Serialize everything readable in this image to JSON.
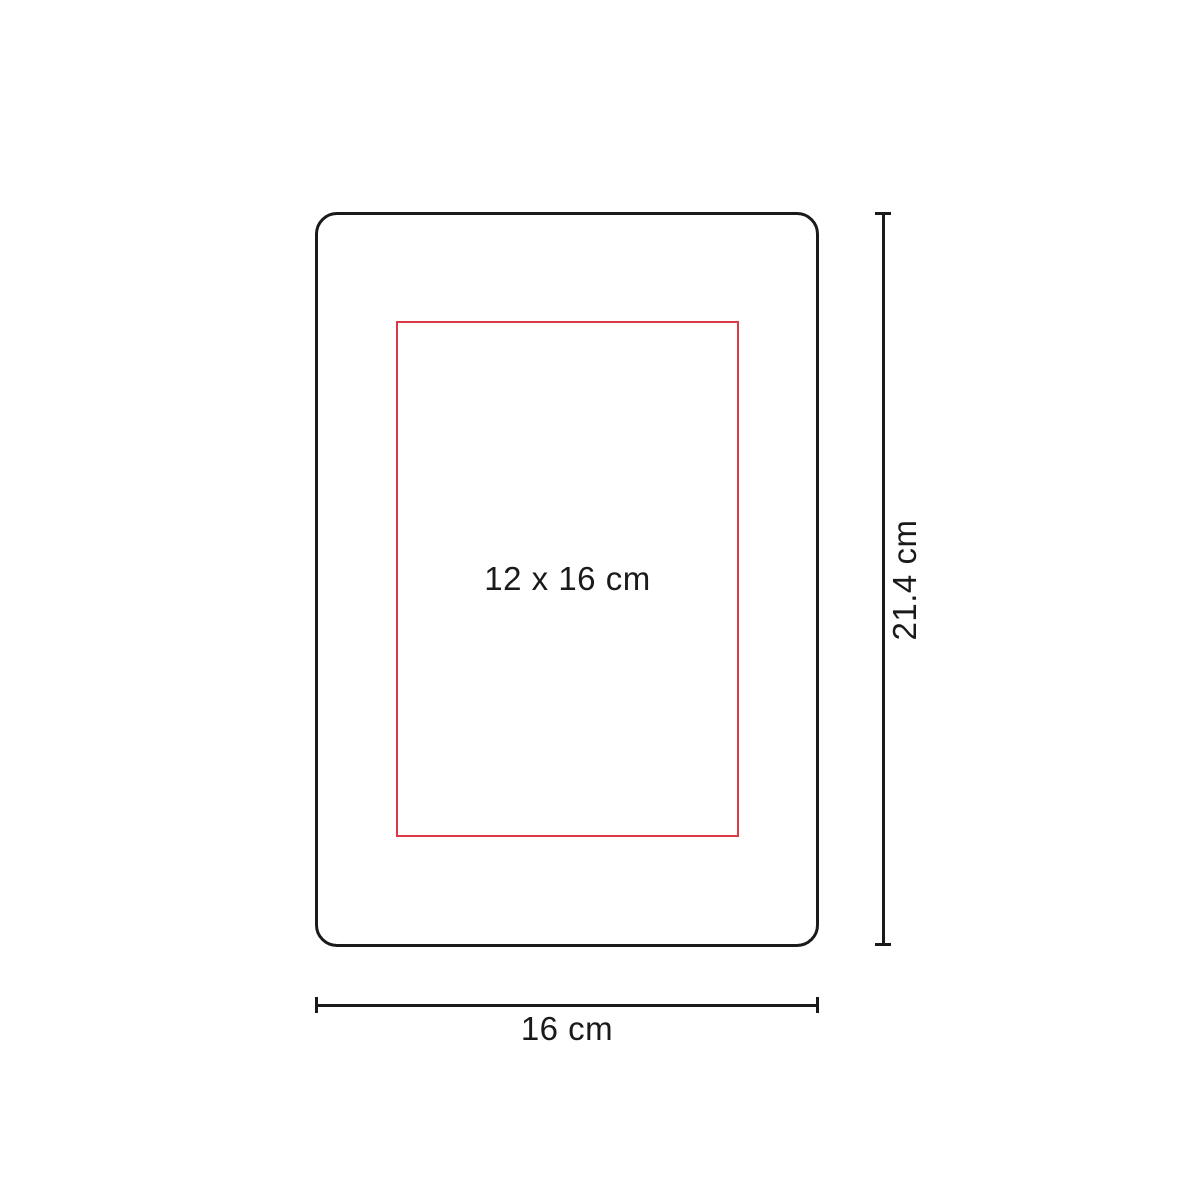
{
  "diagram": {
    "type": "product-dimension-diagram",
    "colors": {
      "line": "#1a1a1a",
      "accent": "#d93a46",
      "text": "#1a1a1a",
      "background": "#ffffff"
    },
    "print_area": {
      "label": "12 x 16 cm"
    },
    "dimensions": {
      "height": {
        "label": "21.4 cm"
      },
      "width": {
        "label": "16 cm"
      }
    }
  }
}
